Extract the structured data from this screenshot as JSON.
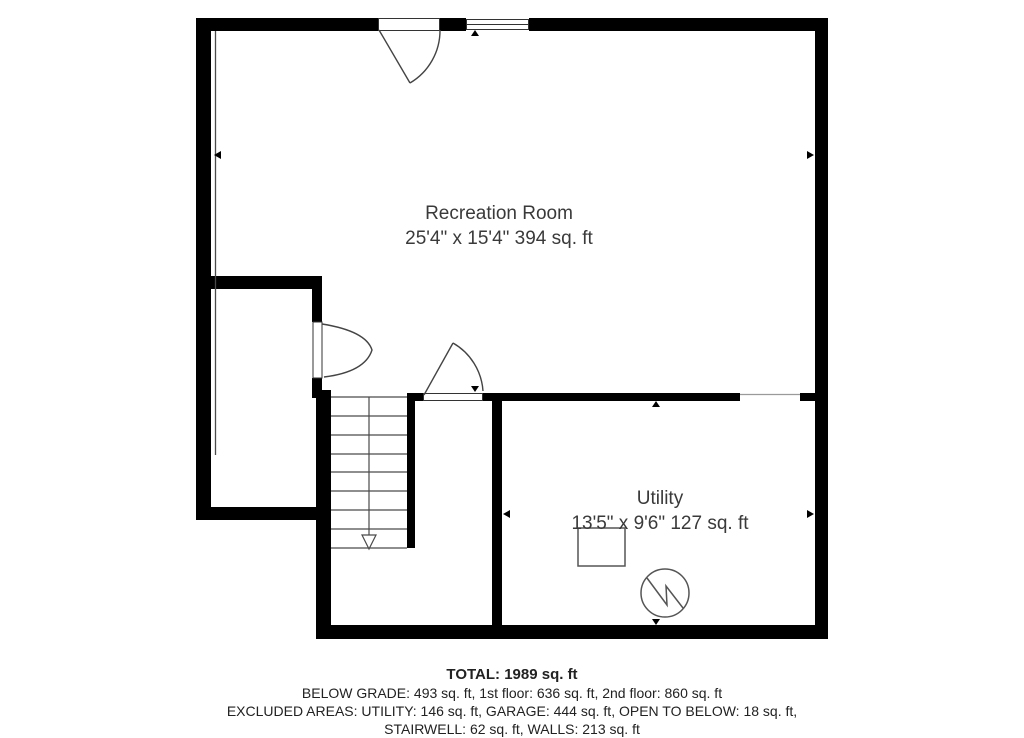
{
  "floor_plan": {
    "background_color": "#ffffff",
    "wall_color": "#000000",
    "line_color": "#4a4a4a",
    "text_color": "#3a3a3a",
    "rooms": [
      {
        "name": "Recreation Room",
        "dimensions": "25'4\" x 15'4\" 394 sq. ft"
      },
      {
        "name": "Utility",
        "dimensions": "13'5\" x 9'6\" 127 sq. ft"
      }
    ],
    "summary": {
      "total": "TOTAL: 1989 sq. ft",
      "line1": "BELOW GRADE: 493 sq. ft, 1st floor: 636 sq. ft, 2nd floor: 860 sq. ft",
      "line2": "EXCLUDED AREAS: UTILITY: 146 sq. ft, GARAGE: 444 sq. ft, OPEN TO BELOW: 18 sq. ft,",
      "line3": "STAIRWELL: 62 sq. ft, WALLS: 213 sq. ft"
    },
    "symbols": [
      "entry-door-swing",
      "window",
      "closet-door-swing",
      "utility-door-swing",
      "stairs-down",
      "furnace",
      "water-heater",
      "dimension-arrows"
    ]
  }
}
